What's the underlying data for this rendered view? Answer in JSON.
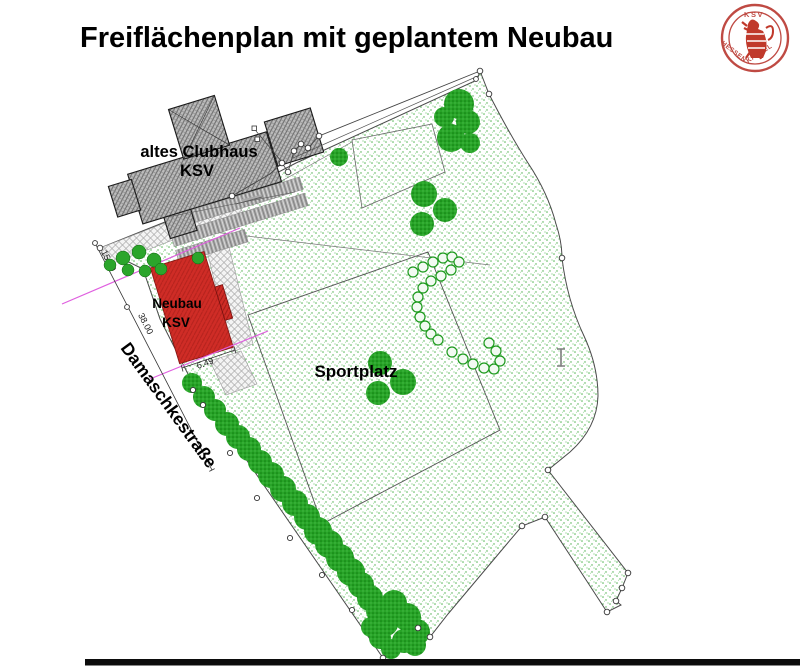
{
  "page": {
    "title": "Freiflächenplan mit geplantem Neubau"
  },
  "logo": {
    "top_text": "KSV",
    "bottom_left_text": "HESSEN",
    "bottom_right_text": "KASSEL"
  },
  "plan": {
    "old_clubhouse": {
      "line1": "altes Clubhaus",
      "line2": "KSV"
    },
    "new_building": {
      "line1": "Neubau",
      "line2": "KSV"
    },
    "sports_field_label": "Sportplatz",
    "street_label": "Damaschkestraße",
    "dimensions": {
      "d1": "15.00",
      "d2": "38.00",
      "d3": "6.49"
    },
    "colors": {
      "new_building_red": "#cf2c26",
      "grass_green": "#57b657",
      "tree_green": "#28a428",
      "logo_red": "#bf4a43",
      "guide_magenta": "#df5fdf"
    }
  }
}
